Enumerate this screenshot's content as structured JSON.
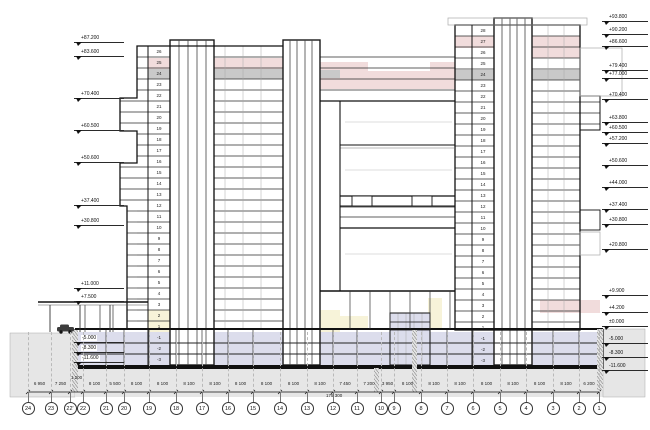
{
  "drawing": {
    "type": "architectural-building-section",
    "colors": {
      "line": "#1a1a1a",
      "pink_band": "#f1dcdc",
      "gray_band": "#c9c9c9",
      "cream_band": "#f7f3d9",
      "basement_fill": "#dcddec",
      "terrain_fill": "#e6e6e6"
    },
    "left_markers": [
      {
        "label": "+87.200",
        "y": 43
      },
      {
        "label": "+83.600",
        "y": 57
      },
      {
        "label": "+70.400",
        "y": 99
      },
      {
        "label": "+60.500",
        "y": 131
      },
      {
        "label": "+50.600",
        "y": 163
      },
      {
        "label": "+37.400",
        "y": 206
      },
      {
        "label": "+30.800",
        "y": 226
      },
      {
        "label": "+11.000",
        "y": 289
      },
      {
        "label": "+7.500",
        "y": 302
      },
      {
        "label": "-5.000",
        "y": 343,
        "bg": true
      },
      {
        "label": "-8.300",
        "y": 353,
        "bg": true
      },
      {
        "label": "-11.600",
        "y": 363,
        "bg": true
      }
    ],
    "right_markers": [
      {
        "label": "+93.800",
        "y": 22
      },
      {
        "label": "+90.200",
        "y": 35
      },
      {
        "label": "+86.600",
        "y": 47
      },
      {
        "label": "+79.400",
        "y": 71
      },
      {
        "label": "+77.000",
        "y": 79
      },
      {
        "label": "+70.400",
        "y": 100
      },
      {
        "label": "+63.800",
        "y": 123
      },
      {
        "label": "+60.500",
        "y": 133
      },
      {
        "label": "+57.200",
        "y": 144
      },
      {
        "label": "+50.600",
        "y": 166
      },
      {
        "label": "+44.000",
        "y": 188
      },
      {
        "label": "+37.400",
        "y": 210
      },
      {
        "label": "+30.800",
        "y": 225
      },
      {
        "label": "+20.800",
        "y": 250
      },
      {
        "label": "+9.900",
        "y": 296
      },
      {
        "label": "+4.200",
        "y": 313
      },
      {
        "label": "±0.000",
        "y": 327
      },
      {
        "label": "-5.000",
        "y": 344
      },
      {
        "label": "-8.300",
        "y": 358
      },
      {
        "label": "-11.600",
        "y": 371
      }
    ],
    "left_tower_floors": [
      "26",
      "25",
      "24",
      "23",
      "22",
      "21",
      "20",
      "19",
      "18",
      "17",
      "16",
      "15",
      "14",
      "13",
      "12",
      "11",
      "10",
      "9",
      "8",
      "7",
      "6",
      "5",
      "4",
      "3",
      "2",
      "1",
      "-1",
      "-2",
      "-3"
    ],
    "right_tower_floors": [
      "28",
      "27",
      "26",
      "25",
      "24",
      "23",
      "22",
      "21",
      "20",
      "19",
      "18",
      "17",
      "16",
      "15",
      "14",
      "13",
      "12",
      "11",
      "10",
      "9",
      "8",
      "7",
      "6",
      "5",
      "4",
      "3",
      "2",
      "1",
      "-1",
      "-2",
      "-3"
    ],
    "grid": {
      "bubbles": [
        {
          "label": "24",
          "x": 28
        },
        {
          "label": "23",
          "x": 51
        },
        {
          "label": "22'",
          "x": 70
        },
        {
          "label": "22",
          "x": 83
        },
        {
          "label": "21",
          "x": 106
        },
        {
          "label": "20",
          "x": 124
        },
        {
          "label": "19",
          "x": 149
        },
        {
          "label": "18",
          "x": 176
        },
        {
          "label": "17",
          "x": 202
        },
        {
          "label": "16",
          "x": 228
        },
        {
          "label": "15",
          "x": 253
        },
        {
          "label": "14",
          "x": 280
        },
        {
          "label": "13",
          "x": 307
        },
        {
          "label": "12",
          "x": 333
        },
        {
          "label": "11",
          "x": 357
        },
        {
          "label": "10",
          "x": 381
        },
        {
          "label": "9",
          "x": 394
        },
        {
          "label": "8",
          "x": 421
        },
        {
          "label": "7",
          "x": 447
        },
        {
          "label": "6",
          "x": 473
        },
        {
          "label": "5",
          "x": 500
        },
        {
          "label": "4",
          "x": 526
        },
        {
          "label": "3",
          "x": 553
        },
        {
          "label": "2",
          "x": 579
        },
        {
          "label": "1",
          "x": 599
        }
      ],
      "dims": [
        "6 950",
        "7 250",
        "1 200",
        "8 100",
        "5 500",
        "8 100",
        "8 100",
        "8 100",
        "8 100",
        "8 100",
        "8 100",
        "8 100",
        "8 100",
        "7 450",
        "7 200",
        "3 950",
        "8 100",
        "8 100",
        "8 100",
        "8 100",
        "8 100",
        "8 100",
        "8 100",
        "6 200"
      ],
      "total": "175 300"
    }
  }
}
